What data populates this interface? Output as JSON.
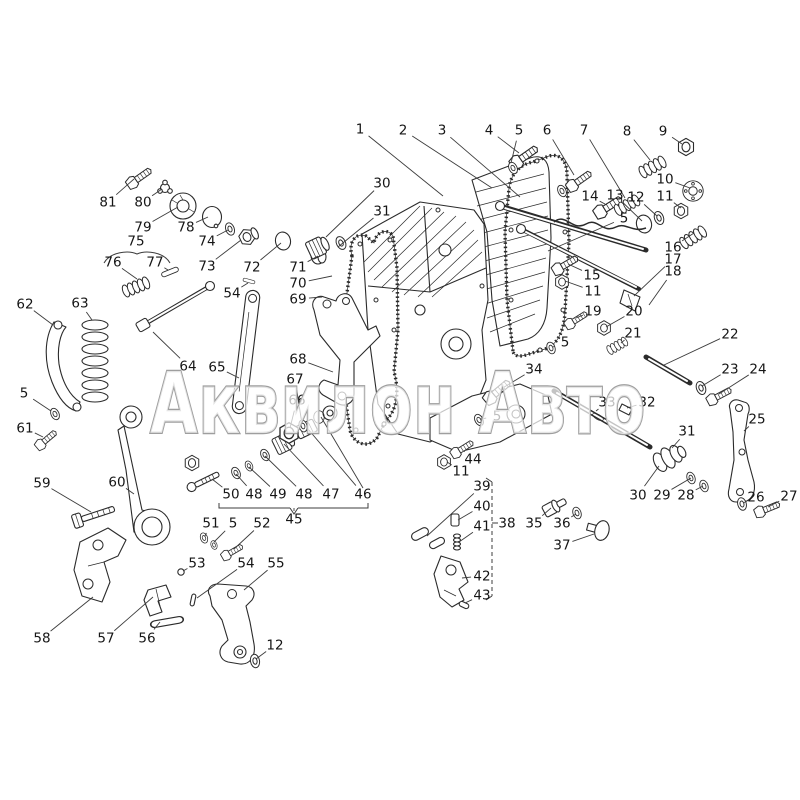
{
  "page": {
    "background": "#ffffff"
  },
  "watermark": {
    "text": "Аквилон Авто",
    "fill_color": "rgba(255,255,255,0.72)",
    "stroke_color": "#9e9e9e"
  },
  "diagram": {
    "description": "Exploded parts diagram of a governor / regulator housing assembly with numbered callouts",
    "ink_color": "#2b2b2b",
    "callouts": [
      {
        "n": "1",
        "x": 360,
        "y": 129,
        "tx": 443,
        "ty": 196
      },
      {
        "n": "2",
        "x": 403,
        "y": 130,
        "tx": 492,
        "ty": 188
      },
      {
        "n": "3",
        "x": 442,
        "y": 130,
        "tx": 520,
        "ty": 197
      },
      {
        "n": "4",
        "x": 489,
        "y": 130,
        "tx": 519,
        "ty": 153
      },
      {
        "n": "5",
        "x": 519,
        "y": 130,
        "tx": 511,
        "ty": 163
      },
      {
        "n": "6",
        "x": 547,
        "y": 130,
        "tx": 574,
        "ty": 175
      },
      {
        "n": "7",
        "x": 584,
        "y": 130,
        "tx": 625,
        "ty": 198
      },
      {
        "n": "8",
        "x": 627,
        "y": 131,
        "tx": 650,
        "ty": 160
      },
      {
        "n": "9",
        "x": 663,
        "y": 131,
        "tx": 682,
        "ty": 144
      },
      {
        "n": "10",
        "x": 665,
        "y": 179,
        "tx": 690,
        "ty": 188
      },
      {
        "n": "11",
        "x": 665,
        "y": 196,
        "tx": 681,
        "ty": 208
      },
      {
        "n": "12",
        "x": 636,
        "y": 197,
        "tx": 657,
        "ty": 216
      },
      {
        "n": "13",
        "x": 615,
        "y": 195,
        "tx": 642,
        "ty": 221
      },
      {
        "n": "14",
        "x": 590,
        "y": 196,
        "tx": 605,
        "ty": 204
      },
      {
        "n": "5",
        "x": 624,
        "y": 218,
        "tx": 548,
        "ty": 251
      },
      {
        "n": "15",
        "x": 592,
        "y": 275,
        "tx": 568,
        "ty": 264
      },
      {
        "n": "11",
        "x": 593,
        "y": 291,
        "tx": 565,
        "ty": 281
      },
      {
        "n": "16",
        "x": 673,
        "y": 247,
        "tx": 694,
        "ty": 233
      },
      {
        "n": "17",
        "x": 673,
        "y": 259,
        "tx": 634,
        "ty": 296
      },
      {
        "n": "18",
        "x": 673,
        "y": 271,
        "tx": 649,
        "ty": 305
      },
      {
        "n": "19",
        "x": 593,
        "y": 311,
        "tx": 576,
        "ty": 318
      },
      {
        "n": "20",
        "x": 634,
        "y": 311,
        "tx": 606,
        "ty": 327
      },
      {
        "n": "21",
        "x": 633,
        "y": 333,
        "tx": 621,
        "ty": 343
      },
      {
        "n": "5",
        "x": 565,
        "y": 342,
        "tx": 553,
        "ty": 347
      },
      {
        "n": "22",
        "x": 730,
        "y": 334,
        "tx": 664,
        "ty": 365
      },
      {
        "n": "23",
        "x": 730,
        "y": 369,
        "tx": 702,
        "ty": 386
      },
      {
        "n": "24",
        "x": 758,
        "y": 369,
        "tx": 719,
        "ty": 394
      },
      {
        "n": "25",
        "x": 757,
        "y": 419,
        "tx": 744,
        "ty": 431
      },
      {
        "n": "26",
        "x": 756,
        "y": 497,
        "tx": 743,
        "ty": 503
      },
      {
        "n": "27",
        "x": 789,
        "y": 496,
        "tx": 768,
        "ty": 507
      },
      {
        "n": "28",
        "x": 686,
        "y": 495,
        "tx": 703,
        "ty": 486
      },
      {
        "n": "29",
        "x": 662,
        "y": 495,
        "tx": 691,
        "ty": 478
      },
      {
        "n": "30",
        "x": 638,
        "y": 495,
        "tx": 659,
        "ty": 466
      },
      {
        "n": "31",
        "x": 687,
        "y": 431,
        "tx": 672,
        "ty": 448
      },
      {
        "n": "32",
        "x": 647,
        "y": 402,
        "tx": 627,
        "ty": 408
      },
      {
        "n": "33",
        "x": 607,
        "y": 402,
        "tx": 596,
        "ty": 411
      },
      {
        "n": "34",
        "x": 534,
        "y": 369,
        "tx": 501,
        "ty": 389
      },
      {
        "n": "5",
        "x": 497,
        "y": 416,
        "tx": 481,
        "ty": 419
      },
      {
        "n": "44",
        "x": 473,
        "y": 459,
        "tx": 464,
        "ty": 451
      },
      {
        "n": "11",
        "x": 461,
        "y": 471,
        "tx": 447,
        "ty": 462
      },
      {
        "n": "35",
        "x": 534,
        "y": 523,
        "tx": 551,
        "ty": 508
      },
      {
        "n": "36",
        "x": 562,
        "y": 523,
        "tx": 576,
        "ty": 514
      },
      {
        "n": "37",
        "x": 562,
        "y": 545,
        "tx": 594,
        "ty": 534
      },
      {
        "n": "38",
        "x": 507,
        "y": 523,
        "tx": 497,
        "ty": 523
      },
      {
        "n": "39",
        "x": 482,
        "y": 486,
        "tx": 427,
        "ty": 536
      },
      {
        "n": "40",
        "x": 482,
        "y": 506,
        "tx": 458,
        "ty": 520
      },
      {
        "n": "41",
        "x": 482,
        "y": 526,
        "tx": 459,
        "ty": 542
      },
      {
        "n": "42",
        "x": 482,
        "y": 576,
        "tx": 462,
        "ty": 578
      },
      {
        "n": "43",
        "x": 482,
        "y": 595,
        "tx": 465,
        "ty": 603
      },
      {
        "n": "45",
        "x": 294,
        "y": 519,
        "tx": 294,
        "ty": 511
      },
      {
        "n": "46",
        "x": 363,
        "y": 494,
        "tx": 308,
        "ty": 429
      },
      {
        "n": "47",
        "x": 331,
        "y": 494,
        "tx": 284,
        "ty": 444
      },
      {
        "n": "48",
        "x": 304,
        "y": 494,
        "tx": 265,
        "ty": 456
      },
      {
        "n": "49",
        "x": 278,
        "y": 494,
        "tx": 249,
        "ty": 467
      },
      {
        "n": "48",
        "x": 254,
        "y": 494,
        "tx": 236,
        "ty": 474
      },
      {
        "n": "50",
        "x": 231,
        "y": 494,
        "tx": 212,
        "ty": 479
      },
      {
        "n": "51",
        "x": 211,
        "y": 523,
        "tx": 205,
        "ty": 536
      },
      {
        "n": "5",
        "x": 233,
        "y": 523,
        "tx": 214,
        "ty": 542
      },
      {
        "n": "52",
        "x": 262,
        "y": 523,
        "tx": 234,
        "ty": 549
      },
      {
        "n": "53",
        "x": 197,
        "y": 563,
        "tx": 183,
        "ty": 571
      },
      {
        "n": "54",
        "x": 246,
        "y": 563,
        "tx": 197,
        "ty": 598
      },
      {
        "n": "55",
        "x": 276,
        "y": 563,
        "tx": 244,
        "ty": 590
      },
      {
        "n": "56",
        "x": 147,
        "y": 638,
        "tx": 160,
        "ty": 622
      },
      {
        "n": "57",
        "x": 106,
        "y": 638,
        "tx": 153,
        "ty": 597
      },
      {
        "n": "58",
        "x": 42,
        "y": 638,
        "tx": 93,
        "ty": 597
      },
      {
        "n": "12",
        "x": 275,
        "y": 645,
        "tx": 256,
        "ty": 659
      },
      {
        "n": "59",
        "x": 42,
        "y": 483,
        "tx": 91,
        "ty": 512
      },
      {
        "n": "60",
        "x": 117,
        "y": 482,
        "tx": 134,
        "ty": 494
      },
      {
        "n": "61",
        "x": 25,
        "y": 428,
        "tx": 43,
        "ty": 437
      },
      {
        "n": "5",
        "x": 24,
        "y": 393,
        "tx": 51,
        "ty": 411
      },
      {
        "n": "62",
        "x": 25,
        "y": 304,
        "tx": 53,
        "ty": 325
      },
      {
        "n": "63",
        "x": 80,
        "y": 303,
        "tx": 92,
        "ty": 320
      },
      {
        "n": "64",
        "x": 188,
        "y": 366,
        "tx": 153,
        "ty": 332
      },
      {
        "n": "65",
        "x": 217,
        "y": 367,
        "tx": 239,
        "ty": 378
      },
      {
        "n": "66",
        "x": 297,
        "y": 400,
        "tx": 290,
        "ty": 428
      },
      {
        "n": "67",
        "x": 295,
        "y": 379,
        "tx": 302,
        "ty": 424
      },
      {
        "n": "68",
        "x": 298,
        "y": 359,
        "tx": 333,
        "ty": 372
      },
      {
        "n": "69",
        "x": 298,
        "y": 299,
        "tx": 322,
        "ty": 297
      },
      {
        "n": "70",
        "x": 298,
        "y": 283,
        "tx": 332,
        "ty": 276
      },
      {
        "n": "71",
        "x": 298,
        "y": 267,
        "tx": 318,
        "ty": 256
      },
      {
        "n": "72",
        "x": 252,
        "y": 267,
        "tx": 281,
        "ty": 243
      },
      {
        "n": "73",
        "x": 207,
        "y": 266,
        "tx": 241,
        "ty": 240
      },
      {
        "n": "74",
        "x": 207,
        "y": 241,
        "tx": 228,
        "ty": 230
      },
      {
        "n": "75",
        "x": 136,
        "y": 241,
        "tx": 137,
        "ty": 252
      },
      {
        "n": "76",
        "x": 113,
        "y": 262,
        "tx": 137,
        "ty": 279
      },
      {
        "n": "77",
        "x": 155,
        "y": 262,
        "tx": 168,
        "ty": 270
      },
      {
        "n": "78",
        "x": 186,
        "y": 227,
        "tx": 208,
        "ty": 217
      },
      {
        "n": "79",
        "x": 143,
        "y": 227,
        "tx": 178,
        "ty": 207
      },
      {
        "n": "80",
        "x": 143,
        "y": 202,
        "tx": 162,
        "ty": 189
      },
      {
        "n": "81",
        "x": 108,
        "y": 202,
        "tx": 134,
        "ty": 179
      },
      {
        "n": "30",
        "x": 382,
        "y": 183,
        "tx": 326,
        "ty": 237
      },
      {
        "n": "31",
        "x": 382,
        "y": 211,
        "tx": 338,
        "ty": 247
      },
      {
        "n": "54",
        "x": 232,
        "y": 293,
        "tx": 248,
        "ty": 283
      }
    ]
  }
}
